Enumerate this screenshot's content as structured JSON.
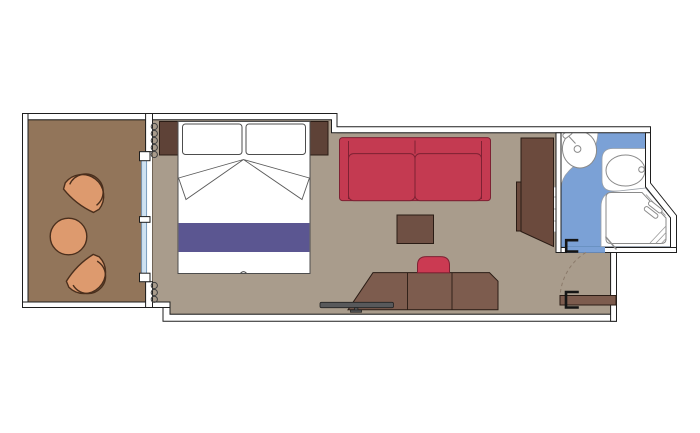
{
  "plan": {
    "type": "cruise-cabin-floor-plan",
    "rooms": [
      {
        "name": "balcony",
        "furniture": [
          "armchair",
          "round-table",
          "armchair"
        ]
      },
      {
        "name": "cabin",
        "furniture": [
          "double-bed",
          "pillow",
          "pillow",
          "nightstand",
          "nightstand",
          "curtain",
          "sofa",
          "coffee-table",
          "desk",
          "desk-chair",
          "tv",
          "wardrobe",
          "entrance-door"
        ]
      },
      {
        "name": "bathroom",
        "furniture": [
          "washbasin",
          "toilet",
          "shower",
          "shelves",
          "bathroom-door"
        ]
      }
    ]
  },
  "colors": {
    "background": "#ffffff",
    "wall": "#ffffff",
    "balcony_floor": "#92755a",
    "cabin_floor": "#a99c8c",
    "bathroom_floor": "#7ba1d6",
    "glass": "#cfe2f2",
    "linen_white": "#ffffff",
    "bed_runner": "#5b5691",
    "sofa_red": "#c43a51",
    "chair_red": "#cb3a52",
    "armchair_tan": "#dd9a6e",
    "nightstand_brown": "#5e4237",
    "wardrobe_brown": "#6b4a3d",
    "desk_brown": "#7d5c4e",
    "coffee_table_brown": "#6f5044",
    "door_brown": "#7d5c4e",
    "tv_gray": "#58595b",
    "fixture_white": "#ffffff"
  }
}
